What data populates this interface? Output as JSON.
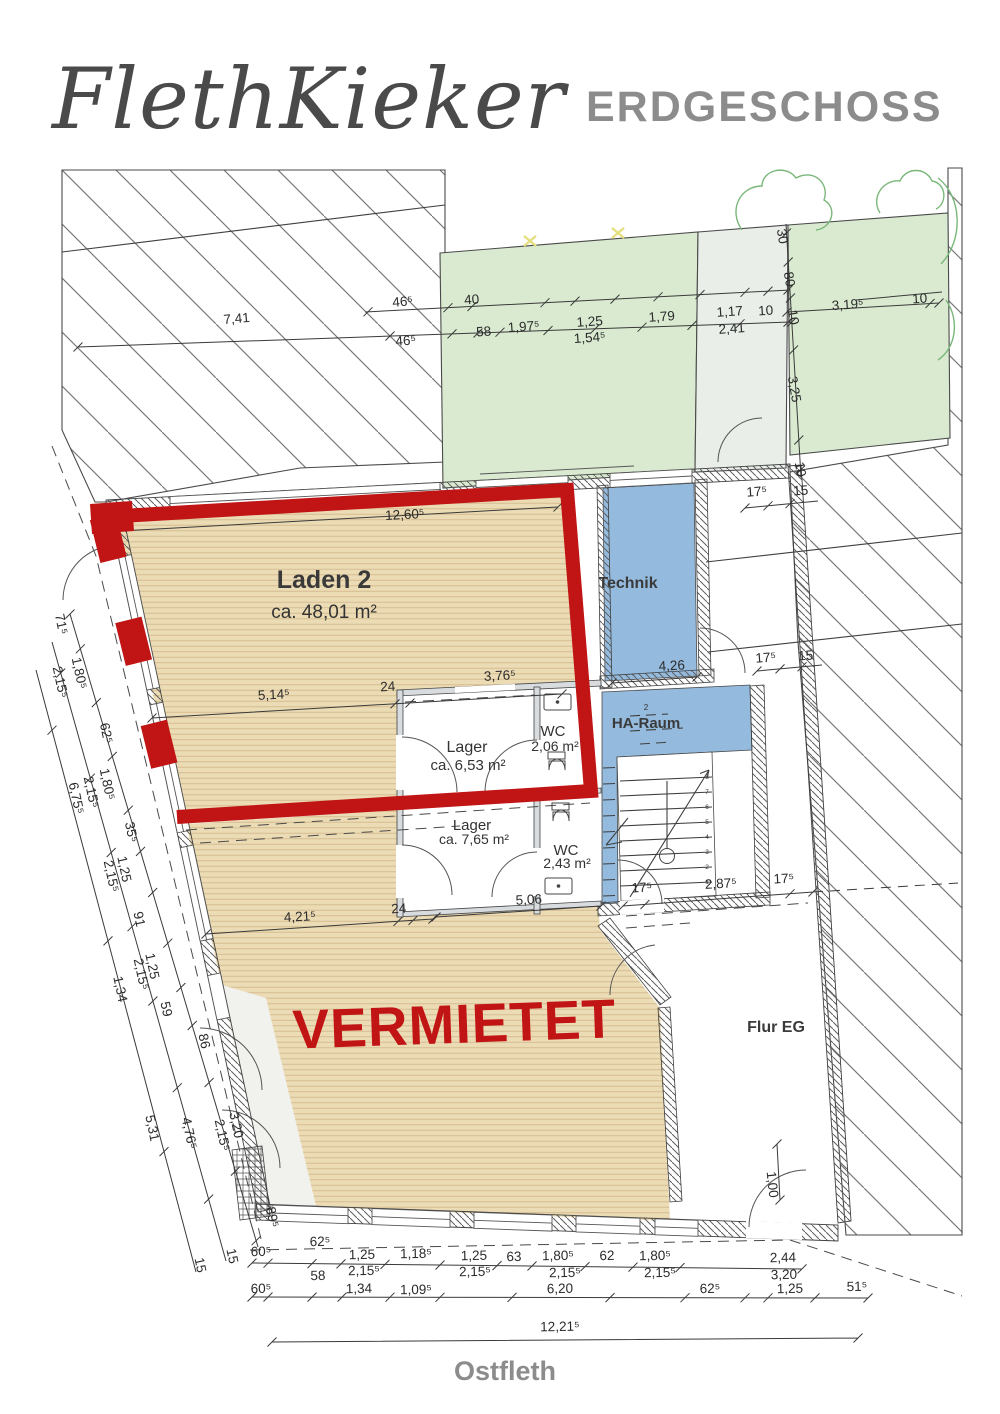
{
  "header": {
    "title": "FlethKieker",
    "floor_label": "ERDGESCHOSS"
  },
  "street_label": "Ostfleth",
  "overlay": {
    "status_label": "VERMIETET"
  },
  "rooms": {
    "laden2": {
      "name": "Laden 2",
      "area": "ca. 48,01 m²"
    },
    "technik": {
      "name": "Technik"
    },
    "haraum": {
      "name": "HA-Raum",
      "tag": "2"
    },
    "lager1": {
      "name": "Lager",
      "area": "ca. 6,53 m²"
    },
    "wc1": {
      "name": "WC",
      "area": "2,06 m²"
    },
    "lager2": {
      "name": "Lager",
      "area": "ca. 7,65 m²"
    },
    "wc2": {
      "name": "WC",
      "area": "2,43 m²"
    },
    "flur": {
      "name": "Flur EG"
    }
  },
  "colors": {
    "highlight_red": "#c11414",
    "floor_beige": "#ecdcb5",
    "garden_green": "#d9ead0",
    "service_blue": "#94badd",
    "title_gray": "#8c8c8c"
  },
  "stair_steps": [
    "1",
    "2",
    "3",
    "4",
    "5",
    "6",
    "7",
    "8"
  ],
  "dimension_labels": [
    {
      "t": "7,41",
      "x": 237,
      "y": 323,
      "r": -5
    },
    {
      "t": "46⁵",
      "x": 403,
      "y": 306,
      "r": -5
    },
    {
      "t": "46⁵",
      "x": 406,
      "y": 345,
      "r": -4
    },
    {
      "t": "40",
      "x": 472,
      "y": 304,
      "r": -4
    },
    {
      "t": "58",
      "x": 484,
      "y": 336,
      "r": -4
    },
    {
      "t": "1,97⁵",
      "x": 524,
      "y": 331,
      "r": -4
    },
    {
      "t": "1,25",
      "x": 590,
      "y": 326,
      "r": -4
    },
    {
      "t": "1,54⁵",
      "x": 590,
      "y": 342,
      "r": -4
    },
    {
      "t": "1,79",
      "x": 662,
      "y": 321,
      "r": -4
    },
    {
      "t": "1,17",
      "x": 730,
      "y": 316,
      "r": -4
    },
    {
      "t": "2,41",
      "x": 732,
      "y": 333,
      "r": -4
    },
    {
      "t": "10",
      "x": 766,
      "y": 315,
      "r": -4
    },
    {
      "t": "30",
      "x": 778,
      "y": 237,
      "r": 80
    },
    {
      "t": "80",
      "x": 785,
      "y": 280,
      "r": 80
    },
    {
      "t": "10",
      "x": 789,
      "y": 318,
      "r": 80
    },
    {
      "t": "3,19⁵",
      "x": 848,
      "y": 309,
      "r": -4
    },
    {
      "t": "10",
      "x": 920,
      "y": 303,
      "r": -4
    },
    {
      "t": "3,25",
      "x": 790,
      "y": 390,
      "r": 80
    },
    {
      "t": "10",
      "x": 796,
      "y": 470,
      "r": 80
    },
    {
      "t": "17⁵",
      "x": 757,
      "y": 496,
      "r": -4
    },
    {
      "t": "15",
      "x": 801,
      "y": 495,
      "r": -4
    },
    {
      "t": "17⁵",
      "x": 766,
      "y": 662,
      "r": -4
    },
    {
      "t": "15",
      "x": 806,
      "y": 660,
      "r": -4
    },
    {
      "t": "12,60⁵",
      "x": 405,
      "y": 519,
      "r": -3
    },
    {
      "t": "5,14⁵",
      "x": 274,
      "y": 699,
      "r": -3
    },
    {
      "t": "24",
      "x": 388,
      "y": 691,
      "r": -3
    },
    {
      "t": "3,76⁵",
      "x": 500,
      "y": 680,
      "r": -3
    },
    {
      "t": "4,26",
      "x": 672,
      "y": 670,
      "r": -3
    },
    {
      "t": "4,21⁵",
      "x": 300,
      "y": 921,
      "r": -3
    },
    {
      "t": "24",
      "x": 399,
      "y": 913,
      "r": -3
    },
    {
      "t": "5,06",
      "x": 529,
      "y": 904,
      "r": -3
    },
    {
      "t": "17⁵",
      "x": 642,
      "y": 892,
      "r": -3
    },
    {
      "t": "2,87⁵",
      "x": 721,
      "y": 888,
      "r": -3
    },
    {
      "t": "17⁵",
      "x": 784,
      "y": 883,
      "r": -3
    },
    {
      "t": "1,00",
      "x": 768,
      "y": 1185,
      "r": 84
    },
    {
      "t": "71⁵",
      "x": 57,
      "y": 625,
      "r": 78
    },
    {
      "t": "1,80⁵",
      "x": 75,
      "y": 674,
      "r": 78
    },
    {
      "t": "2,15⁵",
      "x": 56,
      "y": 683,
      "r": 78
    },
    {
      "t": "62⁵",
      "x": 102,
      "y": 734,
      "r": 78
    },
    {
      "t": "1,80⁵",
      "x": 103,
      "y": 785,
      "r": 78
    },
    {
      "t": "2,15⁵",
      "x": 87,
      "y": 793,
      "r": 78
    },
    {
      "t": "6,75⁵",
      "x": 72,
      "y": 799,
      "r": 78
    },
    {
      "t": "35⁵",
      "x": 127,
      "y": 833,
      "r": 78
    },
    {
      "t": "1,25",
      "x": 120,
      "y": 870,
      "r": 78
    },
    {
      "t": "2,15⁵",
      "x": 107,
      "y": 877,
      "r": 78
    },
    {
      "t": "91",
      "x": 135,
      "y": 920,
      "r": 78
    },
    {
      "t": "1,25",
      "x": 148,
      "y": 967,
      "r": 78
    },
    {
      "t": "2,15⁵",
      "x": 137,
      "y": 975,
      "r": 78
    },
    {
      "t": "1,34",
      "x": 116,
      "y": 990,
      "r": 78
    },
    {
      "t": "59",
      "x": 162,
      "y": 1010,
      "r": 78
    },
    {
      "t": "86",
      "x": 200,
      "y": 1042,
      "r": 78
    },
    {
      "t": "3,20",
      "x": 232,
      "y": 1126,
      "r": 78
    },
    {
      "t": "2,15⁵",
      "x": 218,
      "y": 1136,
      "r": 78
    },
    {
      "t": "5,31",
      "x": 148,
      "y": 1129,
      "r": 78
    },
    {
      "t": "4,76⁵",
      "x": 185,
      "y": 1134,
      "r": 78
    },
    {
      "t": "89⁵",
      "x": 268,
      "y": 1218,
      "r": 78
    },
    {
      "t": "15",
      "x": 228,
      "y": 1257,
      "r": 78
    },
    {
      "t": "15",
      "x": 196,
      "y": 1266,
      "r": 78
    },
    {
      "t": "62⁵",
      "x": 320,
      "y": 1246,
      "r": -1
    },
    {
      "t": "60⁵",
      "x": 261,
      "y": 1256,
      "r": -1
    },
    {
      "t": "1,25",
      "x": 362,
      "y": 1259,
      "r": -1
    },
    {
      "t": "1,18⁵",
      "x": 416,
      "y": 1258,
      "r": -1
    },
    {
      "t": "1,25",
      "x": 474,
      "y": 1260,
      "r": -1
    },
    {
      "t": "63",
      "x": 514,
      "y": 1261,
      "r": -1
    },
    {
      "t": "1,80⁵",
      "x": 558,
      "y": 1260,
      "r": -1
    },
    {
      "t": "62",
      "x": 607,
      "y": 1260,
      "r": -1
    },
    {
      "t": "1,80⁵",
      "x": 655,
      "y": 1260,
      "r": -1
    },
    {
      "t": "2,44",
      "x": 783,
      "y": 1262,
      "r": -1
    },
    {
      "t": "58",
      "x": 318,
      "y": 1280,
      "r": -1
    },
    {
      "t": "2,15⁵",
      "x": 364,
      "y": 1275,
      "r": -1
    },
    {
      "t": "2,15⁵",
      "x": 475,
      "y": 1276,
      "r": -1
    },
    {
      "t": "2,15⁵",
      "x": 565,
      "y": 1277,
      "r": -1
    },
    {
      "t": "2,15⁵",
      "x": 660,
      "y": 1277,
      "r": -1
    },
    {
      "t": "3,20",
      "x": 784,
      "y": 1279,
      "r": -1
    },
    {
      "t": "60⁵",
      "x": 261,
      "y": 1293,
      "r": -1
    },
    {
      "t": "1,34",
      "x": 359,
      "y": 1293,
      "r": -1
    },
    {
      "t": "1,09⁵",
      "x": 416,
      "y": 1294,
      "r": -1
    },
    {
      "t": "6,20",
      "x": 560,
      "y": 1293,
      "r": -1
    },
    {
      "t": "62⁵",
      "x": 710,
      "y": 1293,
      "r": -1
    },
    {
      "t": "1,25",
      "x": 790,
      "y": 1293,
      "r": -1
    },
    {
      "t": "51⁵",
      "x": 857,
      "y": 1291,
      "r": -1
    },
    {
      "t": "12,21⁵",
      "x": 560,
      "y": 1331,
      "r": -1
    }
  ]
}
